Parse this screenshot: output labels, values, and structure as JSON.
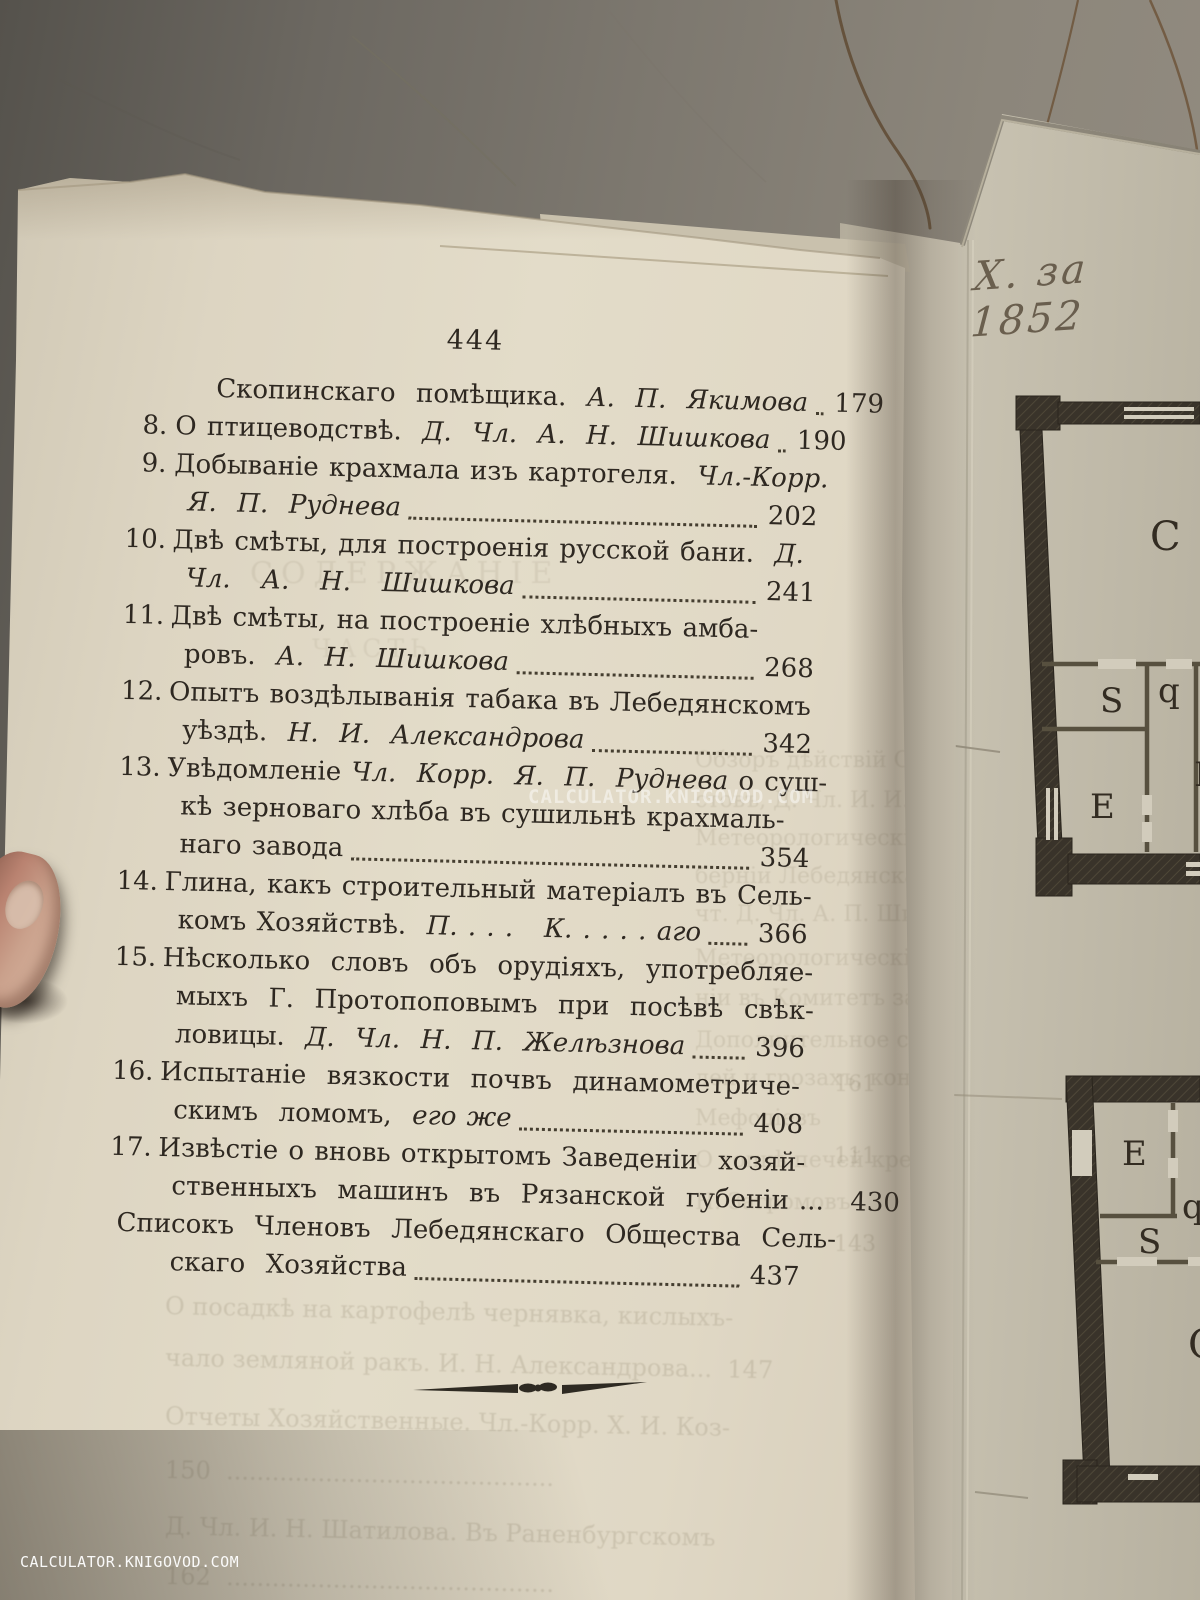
{
  "meta": {
    "page_number": "444",
    "divider_ornament": "tailpiece-rule"
  },
  "colors": {
    "paper": "#ddd5c2",
    "ink": "#2e2821",
    "wall": "#7d786f",
    "plan_wall": "#39332a",
    "crack": "#6b5136"
  },
  "watermarks": {
    "center": "CALCULATOR.KNIGOVOD.COM",
    "corner": "CALCULATOR.KNIGOVOD.COM"
  },
  "plate": {
    "annotation": "Х. за 1852",
    "upper_plan": {
      "rooms": [
        "C",
        "S",
        "q",
        "E",
        "B"
      ]
    },
    "lower_plan": {
      "rooms": [
        "E",
        "q",
        "S",
        "C"
      ]
    }
  },
  "toc": {
    "entries": [
      {
        "num": "",
        "page": "179",
        "lines": [
          {
            "ind": 2,
            "lead": true,
            "segs": [
              {
                "t": "Скопинскаго  помѣщика.  ",
                "i": false
              },
              {
                "t": "А.  П.  Якимова",
                "i": true
              }
            ]
          }
        ]
      },
      {
        "num": "8.",
        "page": "190",
        "lines": [
          {
            "ind": 0,
            "lead": true,
            "segs": [
              {
                "t": "О птицеводствѣ.  ",
                "i": false
              },
              {
                "t": "Д.  Чл.  А.  Н.  Шишкова",
                "i": true
              }
            ]
          }
        ]
      },
      {
        "num": "9.",
        "page": "202",
        "lines": [
          {
            "ind": 0,
            "lead": false,
            "segs": [
              {
                "t": "Добываніе крахмала изъ картогеля.  ",
                "i": false
              },
              {
                "t": "Чл.-Корр.",
                "i": true
              }
            ]
          },
          {
            "ind": 1,
            "lead": true,
            "segs": [
              {
                "t": "Я.  П.  Руднева",
                "i": true
              }
            ]
          }
        ]
      },
      {
        "num": "10.",
        "page": "241",
        "lines": [
          {
            "ind": 0,
            "lead": false,
            "segs": [
              {
                "t": "Двѣ смѣты, для построенія русской бани.  ",
                "i": false
              },
              {
                "t": "Д.",
                "i": true
              }
            ]
          },
          {
            "ind": 1,
            "lead": true,
            "segs": [
              {
                "t": "Чл.   А.   Н.   Шишкова",
                "i": true
              }
            ]
          }
        ]
      },
      {
        "num": "11.",
        "page": "268",
        "lines": [
          {
            "ind": 0,
            "lead": false,
            "segs": [
              {
                "t": "Двѣ смѣты, на построеніе хлѣбныхъ амба-",
                "i": false
              }
            ]
          },
          {
            "ind": 1,
            "lead": true,
            "segs": [
              {
                "t": "ровъ.  ",
                "i": false
              },
              {
                "t": "А.  Н.  Шишкова",
                "i": true
              }
            ]
          }
        ]
      },
      {
        "num": "12.",
        "page": "342",
        "lines": [
          {
            "ind": 0,
            "lead": false,
            "segs": [
              {
                "t": "Опытъ воздѣлыванія табака въ Лебедянскомъ",
                "i": false
              }
            ]
          },
          {
            "ind": 1,
            "lead": true,
            "segs": [
              {
                "t": "уѣздѣ.  ",
                "i": false
              },
              {
                "t": "Н.  И.  Александрова",
                "i": true
              }
            ]
          }
        ]
      },
      {
        "num": "13.",
        "page": "354",
        "lines": [
          {
            "ind": 0,
            "lead": false,
            "segs": [
              {
                "t": "Увѣдомленіе ",
                "i": false
              },
              {
                "t": "Чл.  Корр.  Я.  П.  Руднева",
                "i": true
              },
              {
                "t": " о суш-",
                "i": false
              }
            ]
          },
          {
            "ind": 1,
            "lead": false,
            "segs": [
              {
                "t": "кѣ зерноваго хлѣба въ сушильнѣ крахмаль-",
                "i": false
              }
            ]
          },
          {
            "ind": 1,
            "lead": true,
            "segs": [
              {
                "t": "наго завода",
                "i": false
              }
            ]
          }
        ]
      },
      {
        "num": "14.",
        "page": "366",
        "lines": [
          {
            "ind": 0,
            "lead": false,
            "segs": [
              {
                "t": "Глина, какъ строительный матеріалъ въ Сель-",
                "i": false
              }
            ]
          },
          {
            "ind": 1,
            "lead": true,
            "segs": [
              {
                "t": "комъ Хозяйствѣ.  ",
                "i": false
              },
              {
                "t": "П. . . .   К. . . . . аго",
                "i": true
              }
            ]
          }
        ]
      },
      {
        "num": "15.",
        "page": "396",
        "lines": [
          {
            "ind": 0,
            "lead": false,
            "segs": [
              {
                "t": "Нѣсколько  словъ  объ  орудіяхъ,  употребляе-",
                "i": false
              }
            ]
          },
          {
            "ind": 1,
            "lead": false,
            "segs": [
              {
                "t": "мыхъ  Г.  Протопоповымъ  при  посѣвѣ  свѣк-",
                "i": false
              }
            ]
          },
          {
            "ind": 1,
            "lead": true,
            "segs": [
              {
                "t": "ловицы.  ",
                "i": false
              },
              {
                "t": "Д.  Чл.  Н.  П.  Желѣзнова",
                "i": true
              }
            ]
          }
        ]
      },
      {
        "num": "16.",
        "page": "408",
        "lines": [
          {
            "ind": 0,
            "lead": false,
            "segs": [
              {
                "t": "Испытаніе  вязкости  почвъ  динамометриче-",
                "i": false
              }
            ]
          },
          {
            "ind": 1,
            "lead": true,
            "segs": [
              {
                "t": "скимъ  ломомъ,  ",
                "i": false
              },
              {
                "t": "его же",
                "i": true
              }
            ]
          }
        ]
      },
      {
        "num": "17.",
        "page": "430",
        "lines": [
          {
            "ind": 0,
            "lead": false,
            "segs": [
              {
                "t": "Извѣстіе о вновь открытомъ Заведеніи  хозяй-",
                "i": false
              }
            ]
          },
          {
            "ind": 1,
            "lead": false,
            "segs": [
              {
                "t": "ственныхъ  машинъ  въ  Рязанской  губеніи ...",
                "i": false
              }
            ]
          }
        ]
      },
      {
        "num": "",
        "page": "437",
        "lines": [
          {
            "ind": -1,
            "lead": false,
            "segs": [
              {
                "t": "Списокъ  Членовъ  Лебедянскаго  Общества  Сель-",
                "i": false
              }
            ]
          },
          {
            "ind": 1,
            "lead": true,
            "segs": [
              {
                "t": "скаго  Хозяйства",
                "i": false
              }
            ]
          }
        ]
      }
    ]
  },
  "show_through": {
    "header_ghost": "СОДЕРЖАНІЕ",
    "subheader_ghost": "ЧАСТЬ",
    "side_lines": [
      "Обзоръ дѣйствій Общества Раненбургскаго",
      "стовъ, Д. Чл. И. И. Около года",
      "Метеорологическій дневникъ, Тамбовской",
      "берніи Лебедянскаго уѣзда, сель хозяйства",
      "чт. Д. Чл. А. П. Шишкова",
      "Метеорологическія наблюденія при посѣвѣ",
      "ніи въ Комитетъ завода. Кор. А. И. Кова",
      "Дополнительное свѣдѣніе о рожаныхъ по-",
      "лей и грозахъ, конца отъ нихъ желѣза. А.И",
      "Мефодіевъ",
      "О топкѣ печей крестьянскихъ избахъ",
      "Н. Загромовъ"
    ],
    "margin_numbers": [
      "161",
      "111",
      "143"
    ],
    "bottom_lines": [
      "О посадкѣ на картофелѣ чернявка, кислыхъ-",
      "чало земляной ракъ. И. Н. Александрова...  147",
      "Отчеты Хозяйственные. Чл.-Корр. Х. И. Коз-",
      "150  ...........................................",
      "Д. Чл. И. Н. Шатилова. Въ Раненбургскомъ",
      "162  ..........................................."
    ]
  }
}
